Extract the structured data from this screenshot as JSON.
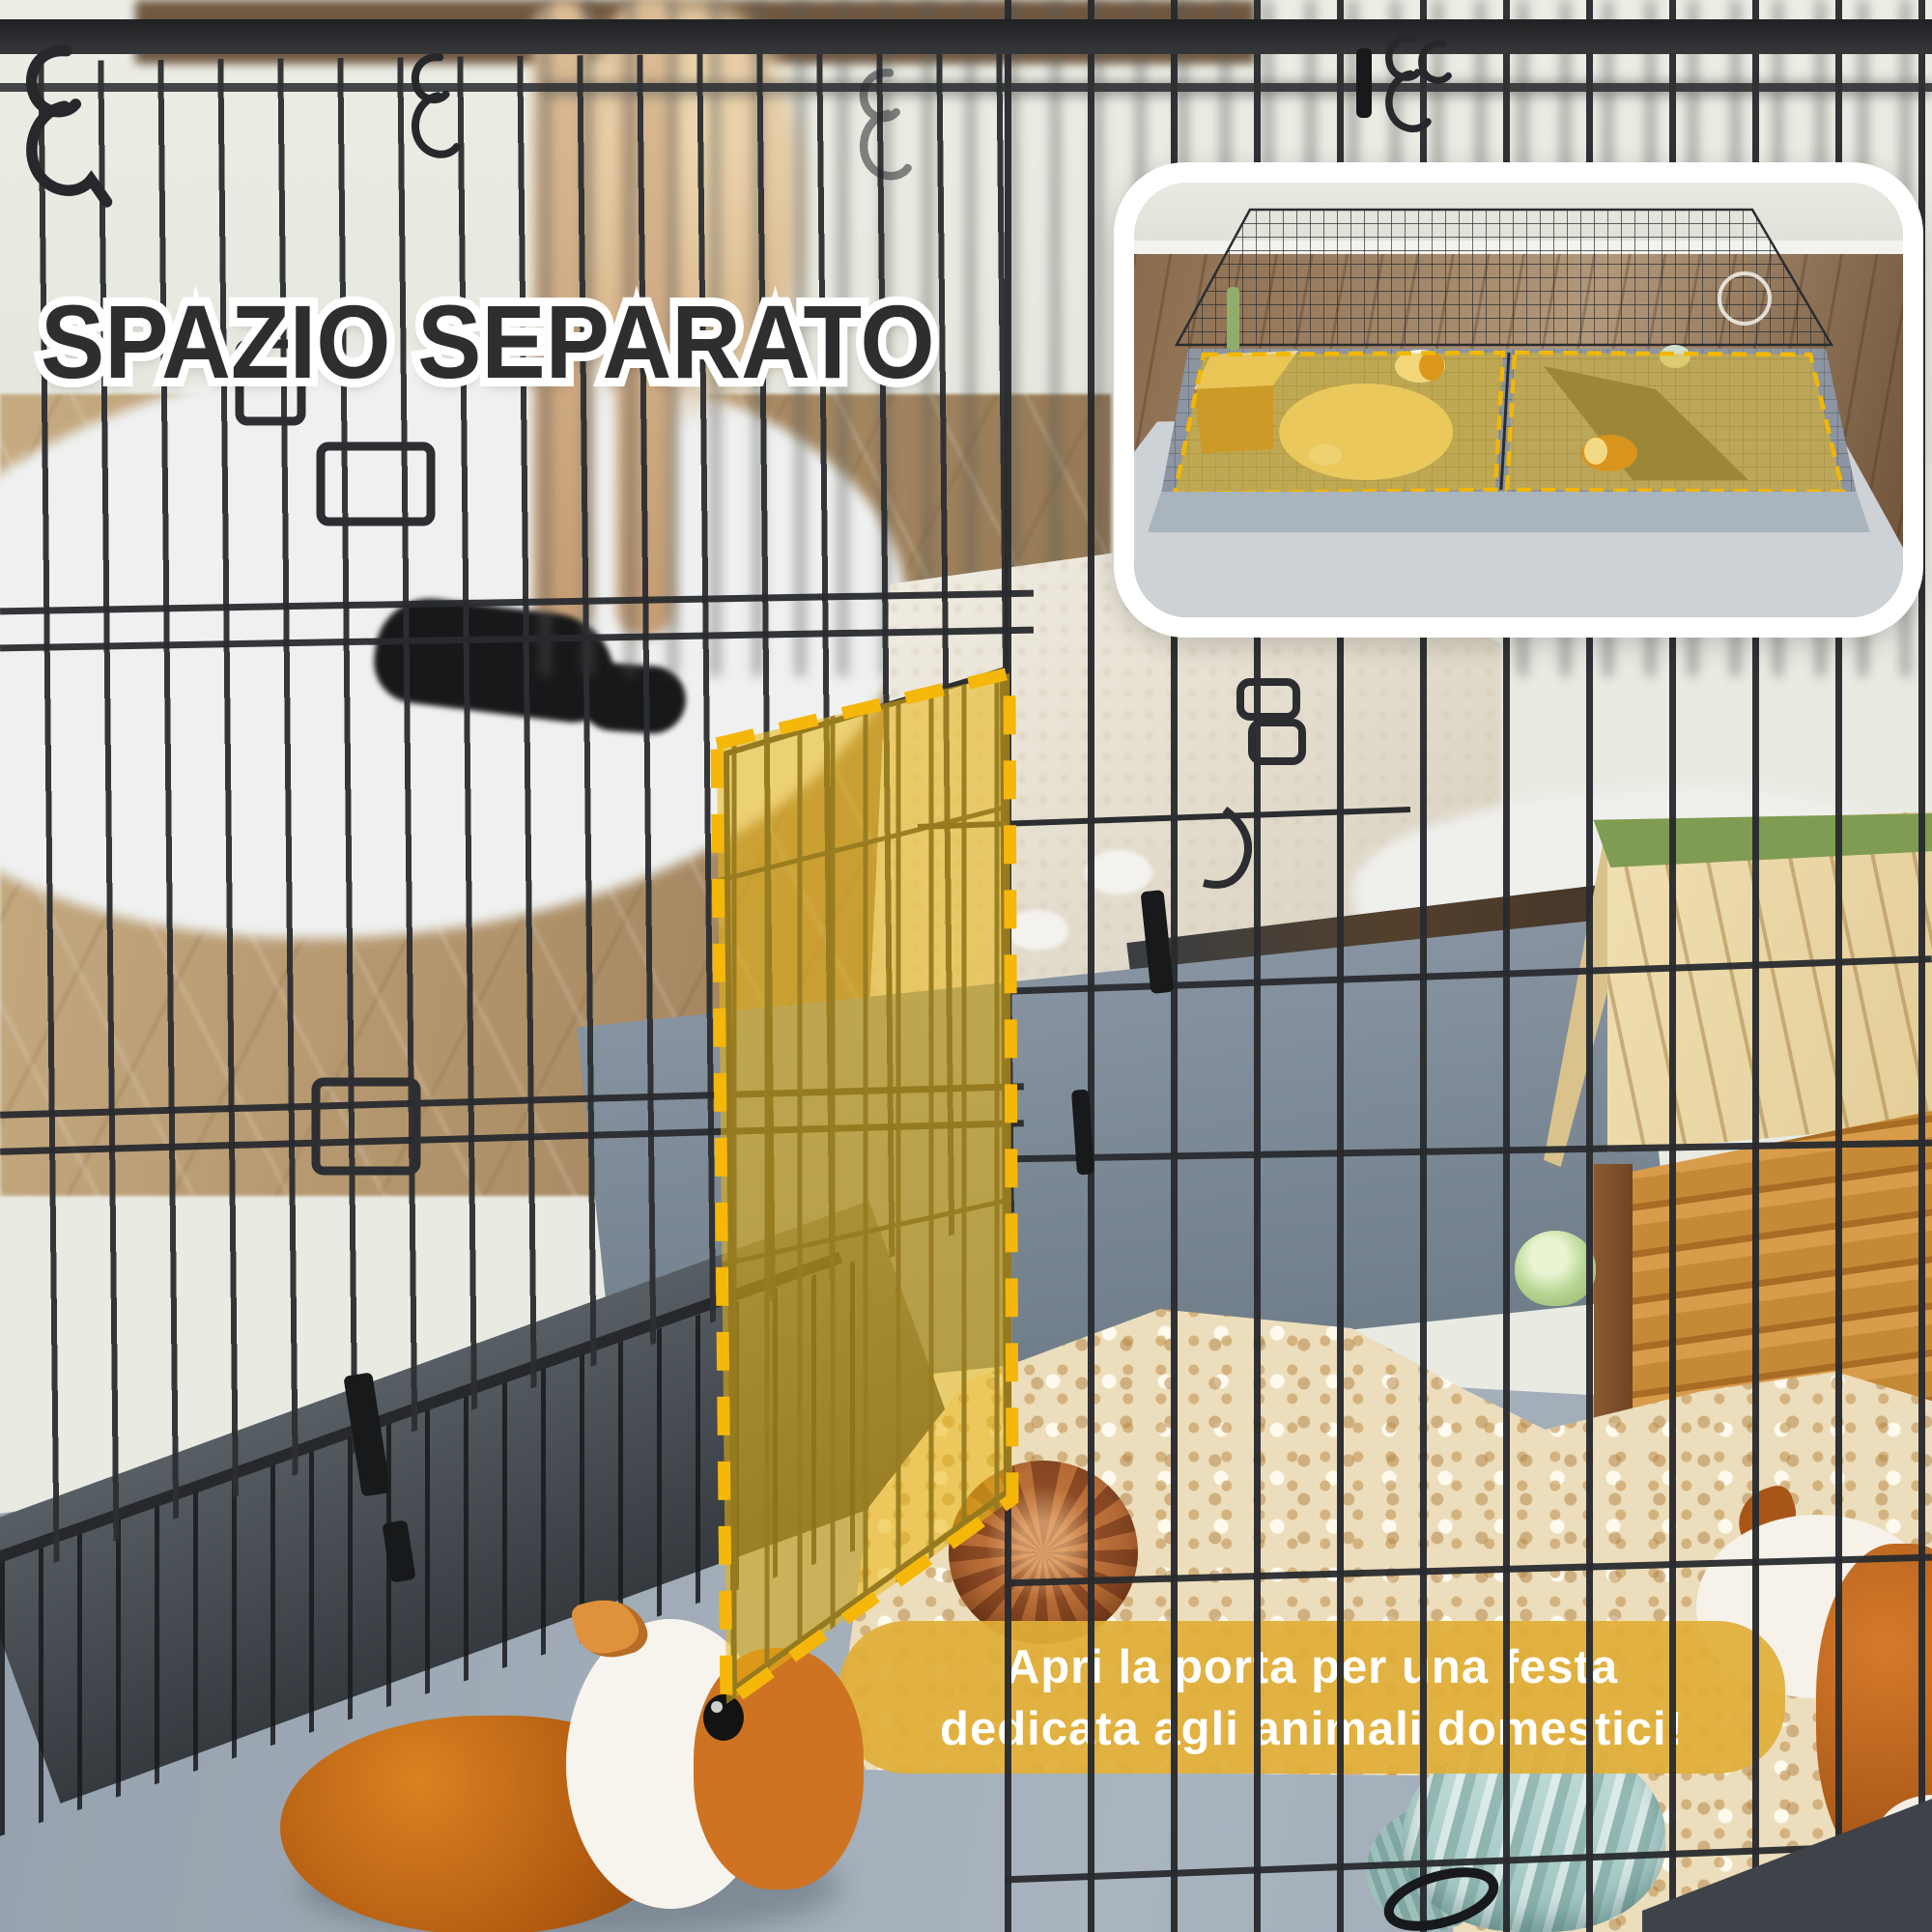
{
  "title": {
    "text": "SPAZIO SEPARATO"
  },
  "caption": {
    "line1": "Apri la porta per una festa",
    "line2": "dedicata agli animali domestici!"
  },
  "palette": {
    "highlight_fill": "#E9B611",
    "highlight_dash": "#F4B70A",
    "caption_bubble": "#E0AE38",
    "title_fill": "#2E2E30",
    "title_outline": "#FFFFFF",
    "wire": "#303234",
    "tray": "#3E434A",
    "pen_floor": "#9FABB6",
    "bedding": "#EBDCBA",
    "wood_floor": "#B69A72",
    "house_wood": "#E9D6A6",
    "house_ridge": "#7F9C52",
    "guinea_pig_orange": "#C96F1E",
    "yarn_teal": "#B9D6D2"
  },
  "scene_objects": [
    "metal wire playpen",
    "highlighted divider door panel",
    "guinea pig orange-white",
    "guinea pig white-orange",
    "wood shavings bedding",
    "pinecone",
    "wooden hideout house",
    "cabbage",
    "yarn ball",
    "white fluffy rug",
    "herringbone wood floor"
  ],
  "inset_objects": [
    "top view of playpen",
    "left highlighted space",
    "right highlighted space",
    "divider panel",
    "hideout house",
    "water bottle",
    "guinea pigs",
    "bedding"
  ]
}
